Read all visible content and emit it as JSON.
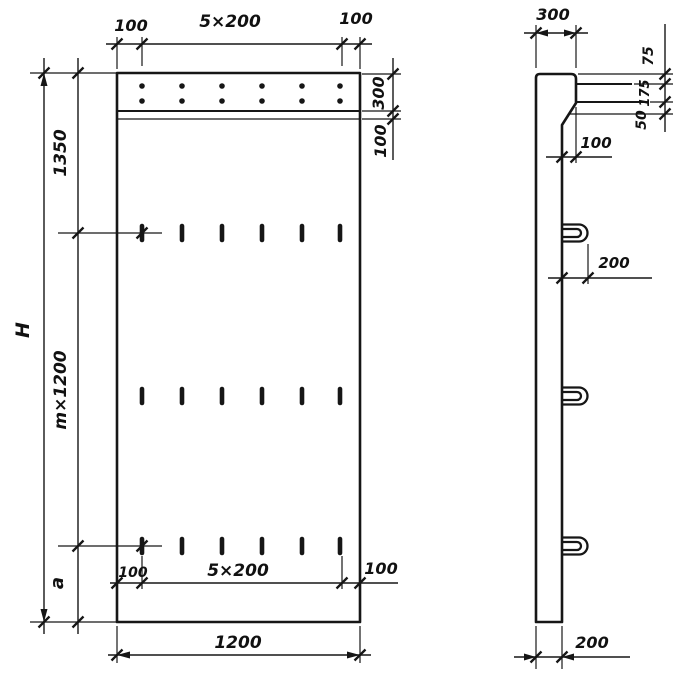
{
  "front_view": {
    "top_dim_left": "100",
    "top_dim_mid": "5×200",
    "top_dim_right": "100",
    "band_height": "300",
    "strip_height": "100",
    "upper_height": "1350",
    "total_height": "H",
    "module_height": "m×1200",
    "bottom_margin": "a",
    "bottom_dim_left": "100",
    "bottom_dim_mid": "5×200",
    "bottom_dim_right": "100",
    "overall_width": "1200"
  },
  "side_view": {
    "top_width": "300",
    "rail_top_offset": "75",
    "rail_gap": "175",
    "chamfer_height": "50",
    "ledge_offset": "100",
    "loop_length": "200",
    "bottom_width": "200"
  }
}
